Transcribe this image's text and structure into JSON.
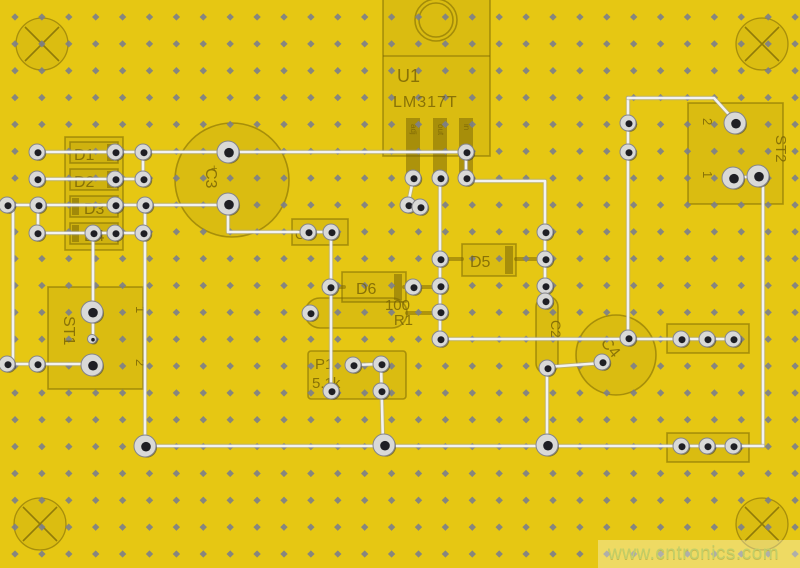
{
  "watermark": {
    "url_text": "www.cntronics.com"
  },
  "silkscreen": {
    "u1": {
      "ref": "U1",
      "part": "LM317T",
      "pin_labels": [
        "adj",
        "out",
        "in"
      ]
    },
    "diodes": {
      "d1": "D1",
      "d2": "D2",
      "d3": "D3",
      "d4": "D4",
      "d5": "D5",
      "d6": "D6"
    },
    "capacitors": {
      "c1": "C1",
      "c2": "C2",
      "c3": "C3",
      "c3_polarity": "+",
      "c4": "C4"
    },
    "resistor": {
      "value": "100",
      "ref": "R1"
    },
    "trimmer": {
      "ref": "P1",
      "value": "5.1k"
    },
    "connectors": {
      "st1": {
        "ref": "ST1",
        "pin1": "1",
        "pin2": "2"
      },
      "st2": {
        "ref": "ST2",
        "pin1": "1",
        "pin2": "2"
      }
    }
  },
  "colors": {
    "board": "#e6c713",
    "hole_dot": "#7b7e8c",
    "trace": "#f2f2f2",
    "trace_edge": "#a0a0a0",
    "silkscreen": "#8f7b12",
    "pad_ring": "#d9d9d7",
    "pad_hole": "#1f1f24",
    "watermark_text": "#c2cf68"
  }
}
